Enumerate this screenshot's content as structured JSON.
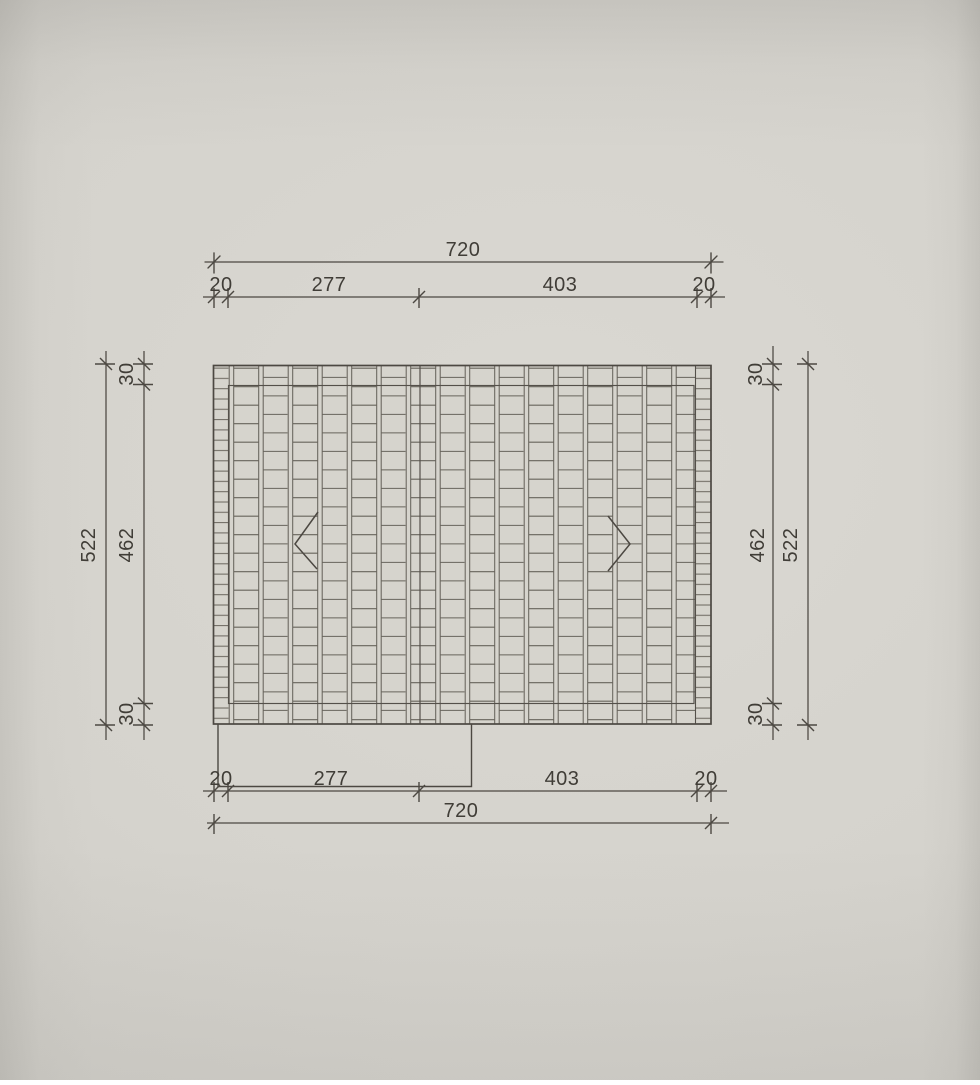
{
  "sheet": {
    "type": "roof-tiling-plan-technical-drawing",
    "colors": {
      "paper": "#d3d1ca",
      "drawing_line": "#54504a",
      "tile_line": "#5d5951",
      "dimension_text": "#403d37"
    }
  },
  "dims": {
    "top": {
      "total": "720",
      "segments": [
        "20",
        "277",
        "403",
        "20"
      ]
    },
    "bottom": {
      "segments": [
        "20",
        "277",
        "403",
        "20"
      ],
      "total": "720"
    },
    "left": {
      "total": "522",
      "edge_top": "30",
      "inner": "462",
      "edge_bottom": "30"
    },
    "right": {
      "edge_top": "30",
      "inner": "462",
      "edge_bottom": "30",
      "total": "522"
    }
  }
}
